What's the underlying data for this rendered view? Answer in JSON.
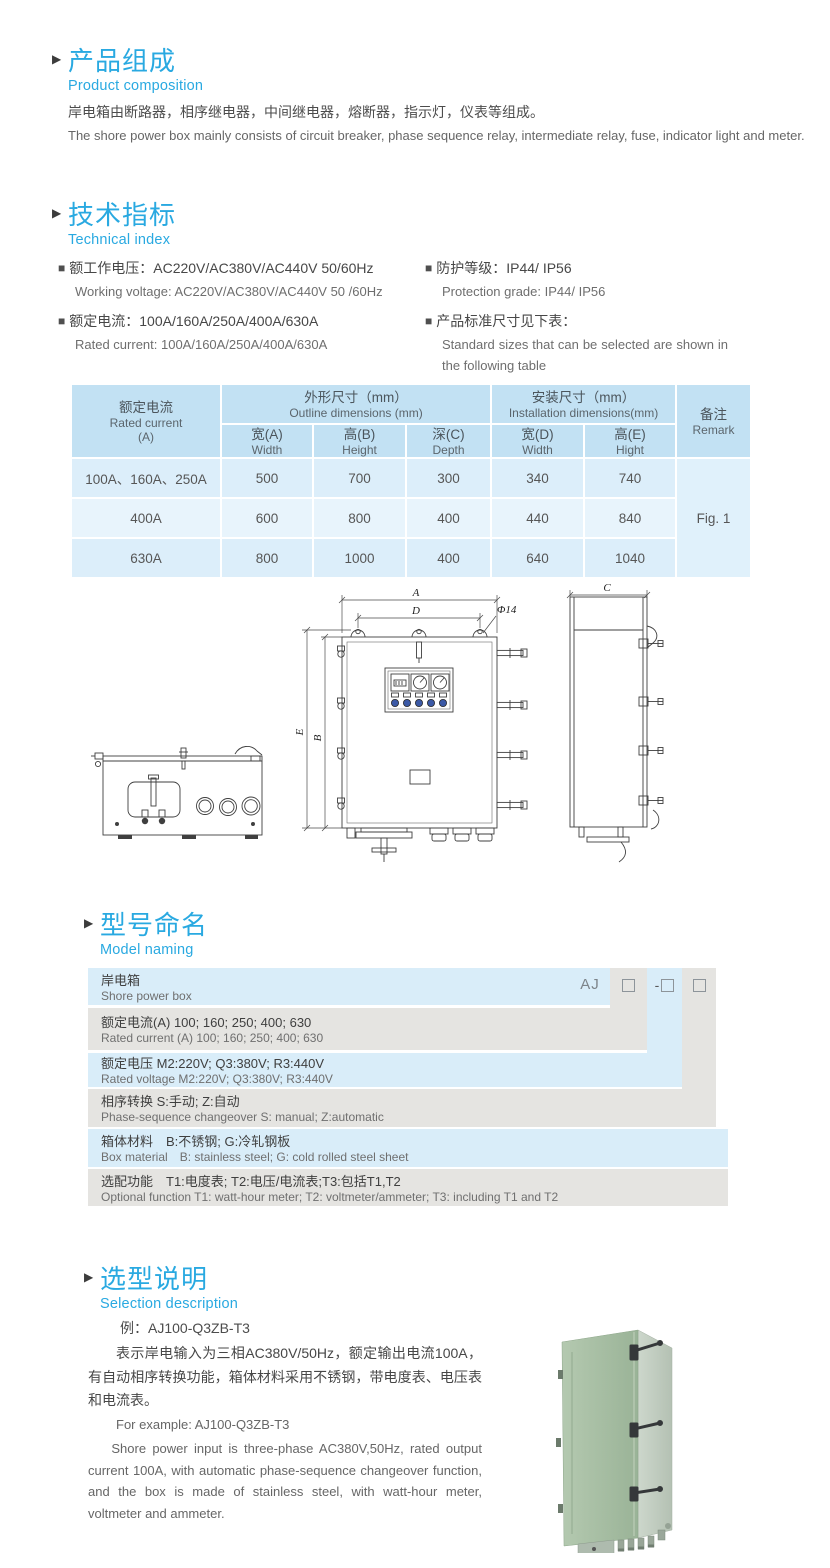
{
  "icons": {
    "section_arrow": "▶",
    "bullet": "■"
  },
  "colors": {
    "accent_blue": "#29a9e1",
    "table_header_bg": "#c2e1f3",
    "table_row_bg": "#dceefa",
    "table_row_alt_bg": "#e8f4fc",
    "model_row_blue": "#d9edf9",
    "model_row_gray": "#e5e4e1",
    "product_green": "#a5bda1"
  },
  "sections": {
    "composition": {
      "title_zh": "产品组成",
      "title_en": "Product  composition",
      "body_zh": "岸电箱由断路器，相序继电器，中间继电器，熔断器，指示灯，仪表等组成。",
      "body_en": "The shore power box mainly consists of circuit breaker, phase sequence relay, intermediate relay, fuse, indicator light and meter."
    },
    "technical": {
      "title_zh": "技术指标",
      "title_en": "Technical index",
      "specs": [
        {
          "zh": "额工作电压：AC220V/AC380V/AC440V  50/60Hz",
          "en": "Working voltage: AC220V/AC380V/AC440V 50 /60Hz"
        },
        {
          "zh": "额定电流：100A/160A/250A/400A/630A",
          "en": "Rated current: 100A/160A/250A/400A/630A"
        },
        {
          "zh": "防护等级：IP44/ IP56",
          "en": "Protection grade: IP44/ IP56"
        },
        {
          "zh": "产品标准尺寸见下表：",
          "en": "Standard sizes that can be selected are shown in the following table"
        }
      ]
    },
    "model_naming": {
      "title_zh": "型号命名",
      "title_en": "Model naming",
      "prefix": "AJ",
      "dash": "-",
      "rows": [
        {
          "zh": "岸电箱",
          "en": "Shore power box"
        },
        {
          "zh": "额定电流(A)  100; 160; 250; 400; 630",
          "en": "Rated current (A) 100; 160; 250; 400; 630"
        },
        {
          "zh": "额定电压  M2:220V;  Q3:380V;  R3:440V",
          "en": "Rated voltage  M2:220V;  Q3:380V;  R3:440V"
        },
        {
          "zh": "相序转换  S:手动; Z:自动",
          "en": "Phase-sequence changeover  S: manual;  Z:automatic"
        },
        {
          "zh": "箱体材料　B:不锈钢;  G:冷轧钢板",
          "en": "Box material　B: stainless steel; G: cold rolled steel sheet"
        },
        {
          "zh": "选配功能　T1:电度表;  T2:电压/电流表;T3:包括T1,T2",
          "en": "Optional function  T1: watt-hour meter; T2: voltmeter/ammeter; T3: including T1 and T2"
        }
      ]
    },
    "selection": {
      "title_zh": "选型说明",
      "title_en": "Selection description",
      "example_zh": "例：AJ100-Q3ZB-T3",
      "body_zh": "表示岸电输入为三相AC380V/50Hz，额定输出电流100A，有自动相序转换功能，箱体材料采用不锈钢，带电度表、电压表和电流表。",
      "example_en": "For example: AJ100-Q3ZB-T3",
      "body_en": "Shore power input is three-phase AC380V,50Hz, rated output current 100A, with automatic phase-sequence changeover function, and the box is made of stainless steel, with watt-hour meter, voltmeter and ammeter."
    }
  },
  "dimension_table": {
    "header": {
      "rated_current_zh": "额定电流",
      "rated_current_en": "Rated current",
      "rated_current_unit": "(A)",
      "outline_zh": "外形尺寸（mm）",
      "outline_en": "Outline dimensions (mm)",
      "install_zh": "安装尺寸（mm）",
      "install_en": "Installation dimensions(mm)",
      "remark_zh": "备注",
      "remark_en": "Remark",
      "sub": [
        {
          "zh": "宽(A)",
          "en": "Width"
        },
        {
          "zh": "高(B)",
          "en": "Height"
        },
        {
          "zh": "深(C)",
          "en": "Depth"
        },
        {
          "zh": "宽(D)",
          "en": "Width"
        },
        {
          "zh": "高(E)",
          "en": "Hight"
        }
      ]
    },
    "rows": [
      {
        "current": "100A、160A、250A",
        "w": "500",
        "h": "700",
        "d": "300",
        "iw": "340",
        "ih": "740"
      },
      {
        "current": "400A",
        "w": "600",
        "h": "800",
        "d": "400",
        "iw": "440",
        "ih": "840"
      },
      {
        "current": "630A",
        "w": "800",
        "h": "1000",
        "d": "400",
        "iw": "640",
        "ih": "1040"
      }
    ],
    "remark_value": "Fig. 1"
  },
  "diagram": {
    "labels": {
      "a": "A",
      "d": "D",
      "phi": "Φ14",
      "b": "B",
      "e": "E",
      "c": "C"
    }
  }
}
